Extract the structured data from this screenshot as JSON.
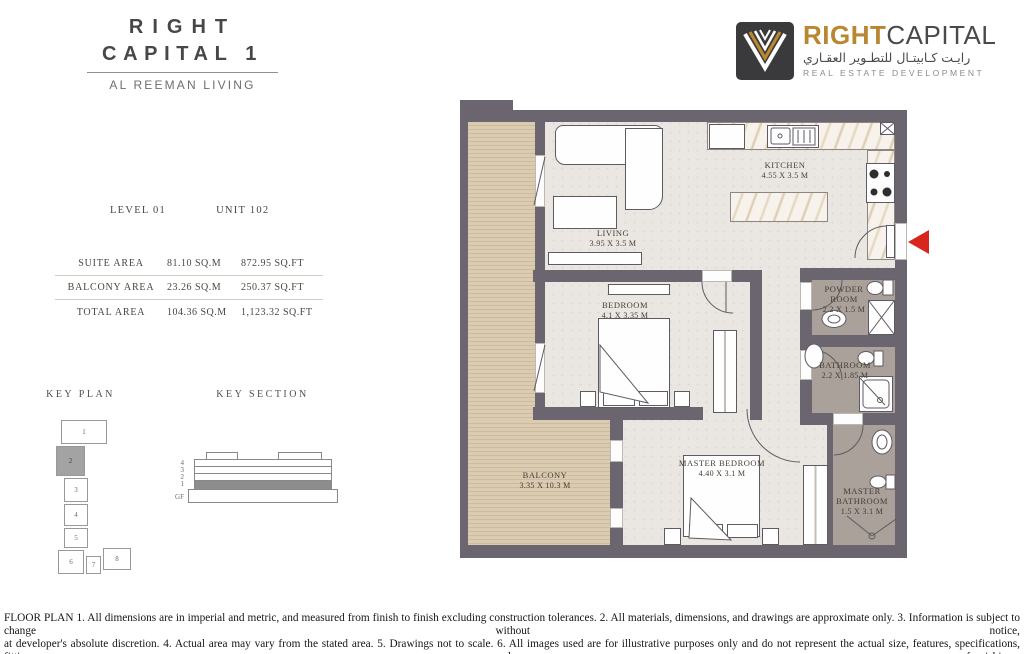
{
  "header": {
    "title_line1": "RIGHT",
    "title_line2": "CAPITAL 1",
    "subtitle": "AL REEMAN LIVING"
  },
  "logo": {
    "brand_gold": "RIGHT",
    "brand_dark": "CAPITAL",
    "arabic": "رايـت كـابيتـال للتطـوير العقـاري",
    "tagline": "REAL ESTATE DEVELOPMENT"
  },
  "unit_info": {
    "level": "LEVEL 01",
    "unit": "UNIT 102"
  },
  "area_table": {
    "rows": [
      {
        "label": "SUITE AREA",
        "sqm": "81.10 SQ.M",
        "sqft": "872.95 SQ.FT"
      },
      {
        "label": "BALCONY AREA",
        "sqm": "23.26 SQ.M",
        "sqft": "250.37 SQ.FT"
      },
      {
        "label": "TOTAL AREA",
        "sqm": "104.36 SQ.M",
        "sqft": "1,123.32 SQ.FT"
      }
    ]
  },
  "key_plan": {
    "label": "KEY PLAN",
    "units": [
      "1",
      "2",
      "3",
      "4",
      "5",
      "6",
      "7",
      "8"
    ],
    "highlighted_unit": "2"
  },
  "key_section": {
    "label": "KEY SECTION",
    "floors": [
      "4",
      "3",
      "2",
      "1",
      "GF"
    ],
    "highlighted_floor": "1"
  },
  "floor_plan": {
    "rooms": {
      "living": {
        "name": "LIVING",
        "dims": "3.95 X 3.5 M"
      },
      "kitchen": {
        "name": "KITCHEN",
        "dims": "4.55 X 3.5 M"
      },
      "bedroom": {
        "name": "BEDROOM",
        "dims": "4.1 X 3.35 M"
      },
      "powder_room": {
        "name": "POWDER ROOM",
        "dims": "2.2 X 1.5 M"
      },
      "bathroom": {
        "name": "BATHROOM",
        "dims": "2.2 X 1.85 M"
      },
      "balcony": {
        "name": "BALCONY",
        "dims": "3.35 X 10.3 M"
      },
      "master_bedroom": {
        "name": "MASTER BEDROOM",
        "dims": "4.40 X 3.1 M"
      },
      "master_bathroom": {
        "name": "MASTER BATHROOM",
        "dims": "1.5 X 3.1 M"
      }
    }
  },
  "disclaimer": {
    "line1": "FLOOR PLAN 1. All dimensions are in imperial and metric, and measured from finish to finish excluding construction tolerances. 2. All materials, dimensions, and drawings are approximate only. 3. Information is subject to change without notice,",
    "line2": "at developer's absolute discretion. 4. Actual area may vary from the stated area. 5. Drawings not to scale. 6. All images used are for illustrative purposes only and do not represent the actual size, features, specifications, fittings, and furnishings.",
    "line3": "7. The developer reserves the right to make revisions / alterations, at it's absolute discretion, without any liability whatsoever."
  },
  "colors": {
    "wall": "#6b6570",
    "floor": "#eae7e2",
    "balcony_wood": "#dacbb1",
    "bath_floor": "#a9a19a",
    "brand_gold": "#b8872f",
    "entry_arrow_red": "#d8261f",
    "key_highlight": "#a3a3a3"
  }
}
